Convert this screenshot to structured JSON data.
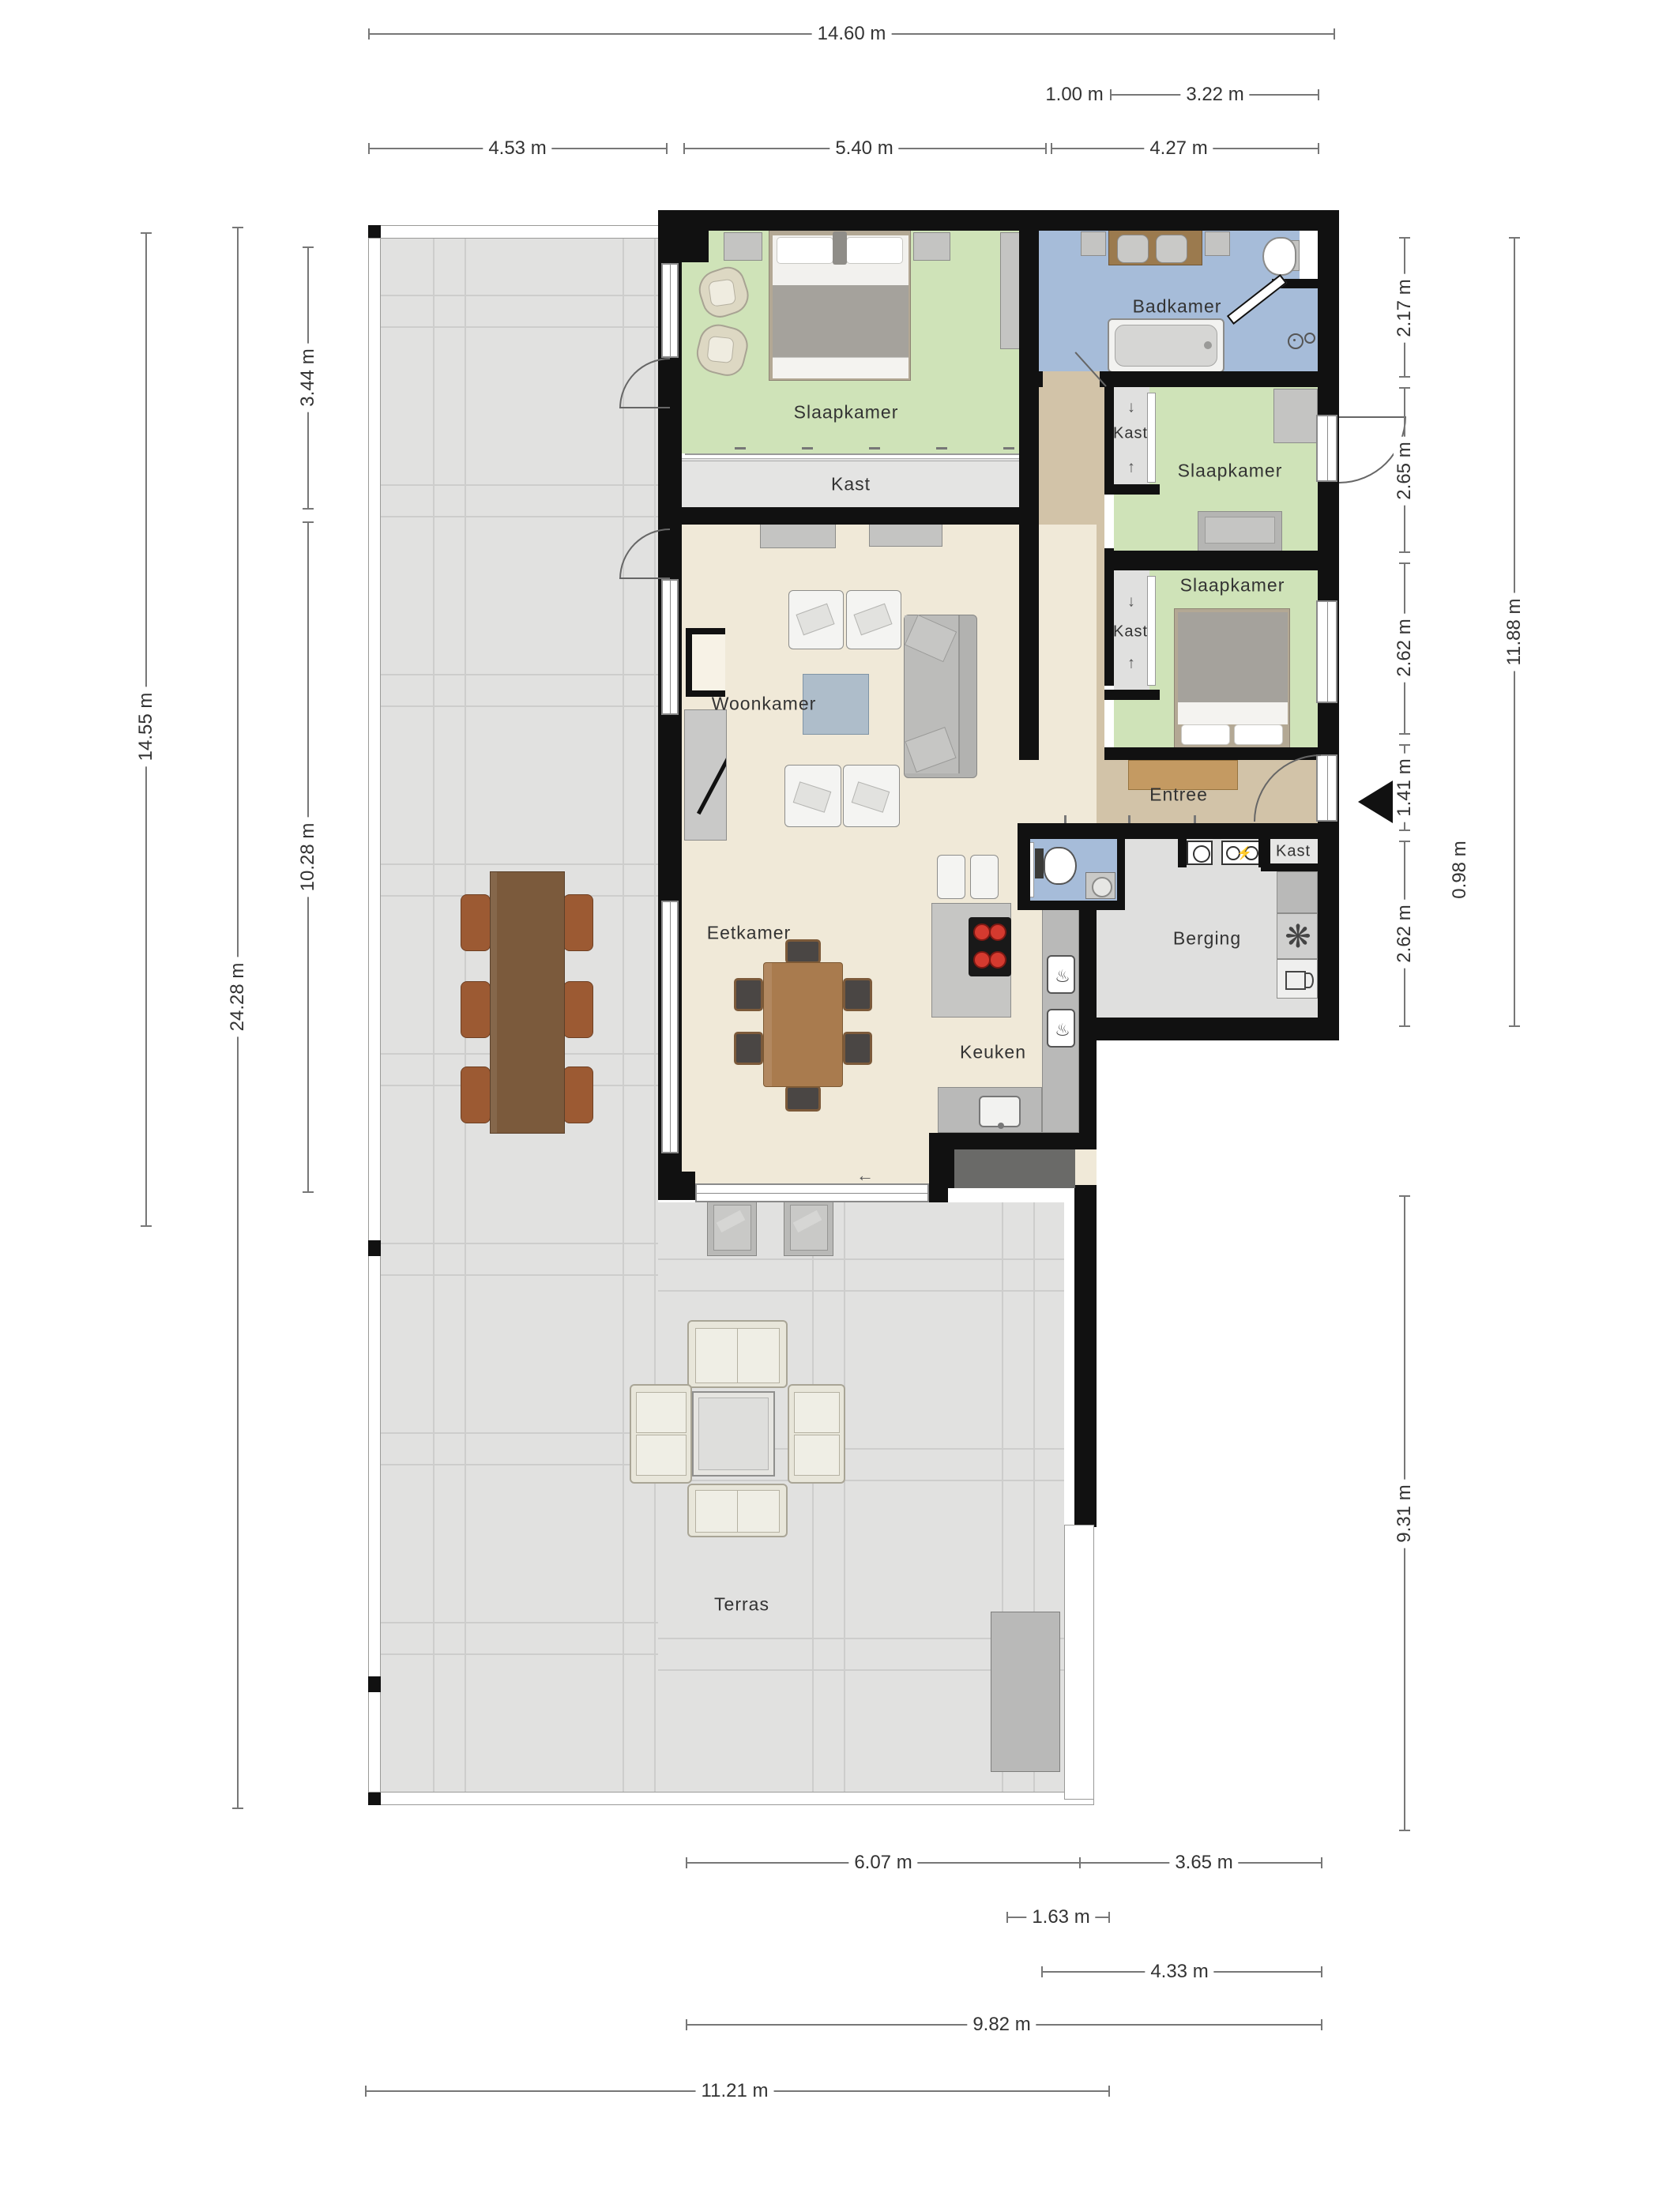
{
  "rooms": {
    "slaapkamer_1": {
      "label": "Slaapkamer"
    },
    "slaapkamer_2": {
      "label": "Slaapkamer"
    },
    "slaapkamer_3": {
      "label": "Slaapkamer"
    },
    "badkamer": {
      "label": "Badkamer"
    },
    "woonkamer": {
      "label": "Woonkamer"
    },
    "eetkamer": {
      "label": "Eetkamer"
    },
    "keuken": {
      "label": "Keuken"
    },
    "entree": {
      "label": "Entree"
    },
    "berging": {
      "label": "Berging"
    },
    "terras": {
      "label": "Terras"
    },
    "kast_slaapkamer_1": {
      "label": "Kast"
    },
    "kast_hal_boven": {
      "label": "Kast"
    },
    "kast_hal_onder": {
      "label": "Kast"
    },
    "kast_entree": {
      "label": "Kast"
    }
  },
  "dims": {
    "top": [
      {
        "id": "overall-width",
        "label": "14.60 m"
      },
      {
        "id": "bath-offset",
        "label": "1.00 m"
      },
      {
        "id": "bath-width",
        "label": "3.22 m"
      },
      {
        "id": "terrace-top-width",
        "label": "4.53 m"
      },
      {
        "id": "bedroom-width",
        "label": "5.40 m"
      },
      {
        "id": "right-wing-width",
        "label": "4.27 m"
      }
    ],
    "left": [
      {
        "id": "bedroom-depth",
        "label": "3.44 m"
      },
      {
        "id": "living-depth",
        "label": "10.28 m"
      },
      {
        "id": "apartment-depth",
        "label": "14.55 m"
      },
      {
        "id": "total-depth",
        "label": "24.28 m"
      }
    ],
    "right": [
      {
        "id": "bath-depth",
        "label": "2.17 m"
      },
      {
        "id": "bedroom2-depth",
        "label": "2.65 m"
      },
      {
        "id": "bedroom3-depth",
        "label": "2.62 m"
      },
      {
        "id": "entree-depth",
        "label": "1.41 m"
      },
      {
        "id": "landing-depth",
        "label": "0.98 m"
      },
      {
        "id": "berging-depth",
        "label": "2.62 m"
      },
      {
        "id": "wing-total-depth",
        "label": "11.88 m"
      },
      {
        "id": "terrace-right-depth",
        "label": "9.31 m"
      }
    ],
    "bottom": [
      {
        "id": "living-width",
        "label": "6.07 m"
      },
      {
        "id": "berging-width",
        "label": "3.65 m"
      },
      {
        "id": "kitchen-exit-width",
        "label": "1.63 m"
      },
      {
        "id": "lower-wing-width",
        "label": "4.33 m"
      },
      {
        "id": "apartment-bottom-width",
        "label": "9.82 m"
      },
      {
        "id": "terrace-bottom-width",
        "label": "11.21 m"
      }
    ]
  },
  "icons": {
    "ventilation": "❋",
    "lightning": "⚡",
    "oven_heat": "♨",
    "arrow_left": "←",
    "arrow_up": "↑",
    "arrow_down": "↓"
  },
  "colors": {
    "wall": "#111111",
    "bedroom_green": "#cfe3b8",
    "bath_blue": "#a6bcd9",
    "living_cream": "#f0e9d8",
    "hall_tan": "#d2c3a8",
    "closet_gray": "#e4e4e3",
    "berging_gray": "#dfdfde",
    "terrace_tile": "#e1e1e0",
    "counter_wood": "#9b7a4e",
    "table_wood": "#a97b4e",
    "burner_red": "#d43a2f"
  }
}
